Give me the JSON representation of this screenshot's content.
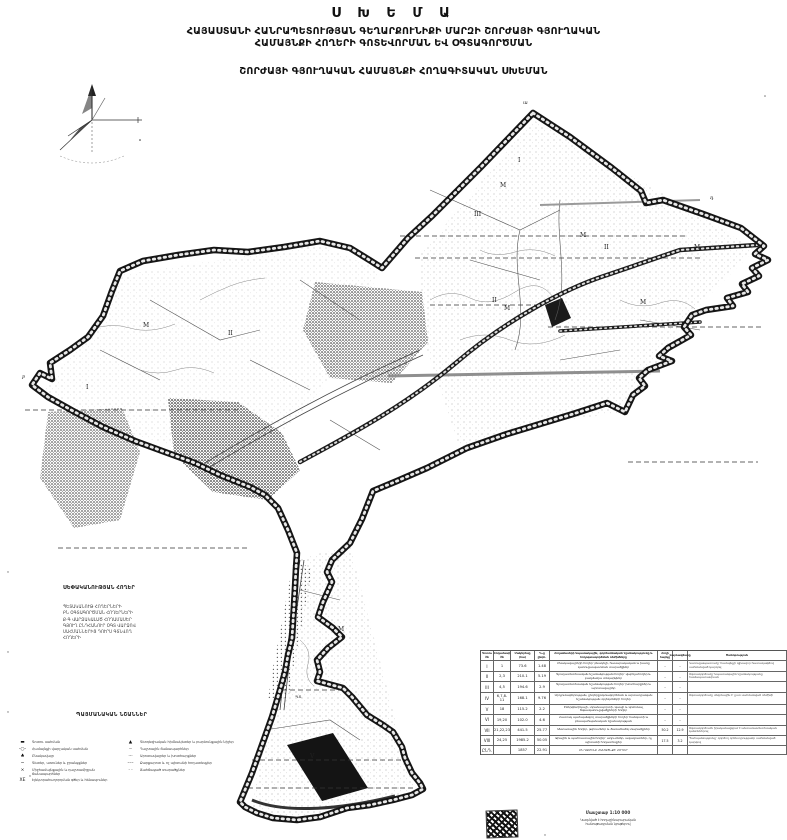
{
  "palette": {
    "ink": "#111111",
    "paper": "#ffffff",
    "boundary": "#1c1c1c",
    "halftone": "#888888"
  },
  "title": {
    "main": "Ս Խ Ե Մ Ա",
    "line1": "ՀԱՅԱՍՏԱՆԻ ՀԱՆՐԱՊԵՏՈՒԹՅԱՆ ԳԵՂԱՐՔՈՒՆԻՔԻ ՄԱՐԶԻ ՇՈՐԺԱՅԻ ԳՅՈՒՂԱԿԱՆ",
    "line2": "ՀԱՄԱՅՆՔԻ ՀՈՂԵՐԻ ԳՈՏԵՎՈՐՄԱՆ ԵՎ ՕԳՏԱԳՈՐԾՄԱՆ",
    "line3": "ՇՈՐԺԱՅԻ ԳՅՈՒՂԱԿԱՆ ՀԱՄԱՅՆՔԻ ՀՈՂԱԳԻՏԱԿԱՆ ՍԽԵՄԱՆ"
  },
  "ownership_legend": {
    "heading": "ՍԵՓԱԿԱՆՈՒԹՅԱՆ ՀՈՂԵՐ",
    "lines": [
      "ՊԵՏԱԿԱՆՈՒԹ ՀՈՂԵՐՆԵՐԻ",
      "ԲՆ ՕԳՏԱԳՈՐԾՄԱՆ ՀՈՂԵՐՆԵՐԻ",
      "Ք-Գ ՎԱՐՁԱԿԱԼԱԾ ՀՈՂԱՄԱՍԵՐ",
      "ԳՅՈՒՂ ԸՆԴՀԱՆՈՒՐ ՕԳՏ ՎԱՐՁՈՎ",
      "ՍԱՀՄԱՆՆԵՐԻՑ ԴՈՒՐՍ ԳՏՆՎՈՂ",
      "ՀՈՂԵՐԻ"
    ]
  },
  "signs_legend": {
    "heading": "ՊԱՅՄԱՆԱԿԱՆ ՆՇԱՆՆԵՐ",
    "left": [
      {
        "glyph": "▬",
        "label": "Գոտու սահման"
      },
      {
        "glyph": "-○-",
        "label": "Համայնքի վարչական սահման"
      },
      {
        "glyph": "♣",
        "label": "Բնակավայր"
      },
      {
        "glyph": "~",
        "label": "Գետեր, առուներ և ջրանցքներ"
      },
      {
        "glyph": "×",
        "label": "Միջհամայնքային և դաշտամիջյան ճանապարհներ"
      },
      {
        "glyph": "XE",
        "label": "Էլեկտրահաղորդման գծեր և հենասյուներ"
      }
    ],
    "right": [
      {
        "glyph": "▲",
        "label": "Գեոդեզիական հիմնակետեր և բարձունքային նիշեր"
      },
      {
        "glyph": "┄",
        "label": "Դաշտային ճանապարհներ"
      },
      {
        "glyph": "···",
        "label": "Արոտավայրեր և խոտհարքներ"
      },
      {
        "glyph": "–·–",
        "label": "Քարքարոտ և ոչ պիտանի հողատեսքեր"
      },
      {
        "glyph": "· ·",
        "label": "Ճահճացած տարածքներ"
      }
    ]
  },
  "table": {
    "headers": {
      "h1": "Գոտու №",
      "h2": "Հողամասի №",
      "h3": "Մակերեսը (հա)",
      "h4": "%-ը ընդհ.",
      "h5": "Հողամասերի նպատակային, գործառնական նշանակությունը և հողօգտագործման ռեժիմները",
      "h6": "Հողի հարկը",
      "h7": "Վարձավճարը",
      "h8": "Ծանոթություն"
    },
    "rows": [
      {
        "zone": "I",
        "parcels": "1",
        "area": "73.6",
        "pct": "1.48",
        "desc": "Բնակավայրերի հողեր՝ բնակելի, հասարակական և խառը կառուցապատման տարածքներ",
        "tax": "–",
        "rent": "–",
        "note": "Կառուցապատումը՝ համայնքի գլխավոր հատակագծով սահմանված կարգով"
      },
      {
        "zone": "II",
        "parcels": "2,3",
        "area": "210.1",
        "pct": "5.19",
        "desc": "Գյուղատնտեսական նշանակության հողեր՝ վարելահողեր և բազմամյա տնկարկներ",
        "tax": "–",
        "rent": "–",
        "note": "Օգտագործումը՝ նպատակային նշանակությանը համապատասխան"
      },
      {
        "zone": "III",
        "parcels": "4,5",
        "area": "194.6",
        "pct": "2.9",
        "desc": "Գյուղատնտեսական նշանակության հողեր՝ խոտհարքներ և արոտավայրեր",
        "tax": "–",
        "rent": "–",
        "note": ""
      },
      {
        "zone": "IV",
        "parcels": "6,7,8-11",
        "area": "168.1",
        "pct": "9.76",
        "desc": "Արդյունաբերության, ընդերքօգտագործման և արտադրական նշանակության օբյեկտների հողեր",
        "tax": "–",
        "rent": "–",
        "note": "Օգտագործումը սեզոնային է՝ ըստ սահմանված ռեժիմի"
      },
      {
        "zone": "V",
        "parcels": "18",
        "area": "115.2",
        "pct": "2.2",
        "desc": "Էներգետիկայի, տրանսպորտի, կապի և կոմունալ ենթակառուցվածքների հողեր",
        "tax": "–",
        "rent": "–",
        "note": ""
      },
      {
        "zone": "VI",
        "parcels": "19,20",
        "area": "102.0",
        "pct": "4.6",
        "desc": "Հատուկ պահպանվող տարածքների հողեր՝ հանգստի և բնապահպանական նշանակության",
        "tax": "–",
        "rent": "–",
        "note": ""
      },
      {
        "zone": "VII",
        "parcels": "21,22,23",
        "area": "441.5",
        "pct": "25.77",
        "desc": "Անտառային հողեր, թփուտներ և ծառածածկ տարածքներ",
        "tax": "50.2",
        "rent": "12.9",
        "note": "Օգտագործումն իրականացվում է անտառատնտեսական կանոններով"
      },
      {
        "zone": "VIII",
        "parcels": "24,25",
        "area": "1985.2",
        "pct": "50.05",
        "desc": "Ջրային և պահուստային հողեր՝ աղուտներ, ավազուտներ, ոչ պիտանի հողատեսքեր",
        "tax": "17.5",
        "rent": "3.2",
        "note": "Պահպանությունը՝ գործող օրենսդրությամբ սահմանված կարգով"
      },
      {
        "zone": "ԸՆԴ.",
        "parcels": "",
        "area": "1857",
        "pct": "22.91",
        "desc": "ԸՆԴԱՄԵՆԸ ՀԱՄԱՅՆՔԻ ՀՈՂԵՐ",
        "tax": "",
        "rent": "",
        "note": ""
      }
    ]
  },
  "footer": {
    "scale": "Մասշտաբ 1:10 000",
    "note1": "Կազմված է հողաշինարարական",
    "note2": "հանութագրման նյութերով"
  },
  "map": {
    "labels": [
      {
        "t": "ա"
      },
      {
        "t": "դ"
      },
      {
        "t": "բ"
      },
      {
        "t": "I"
      },
      {
        "t": "M"
      },
      {
        "t": "III"
      },
      {
        "t": "M"
      },
      {
        "t": "II"
      },
      {
        "t": "M"
      },
      {
        "t": "II"
      },
      {
        "t": "M"
      },
      {
        "t": "M"
      },
      {
        "t": "M"
      },
      {
        "t": "II"
      },
      {
        "t": "I"
      },
      {
        "t": "M"
      },
      {
        "t": "ՊՏ"
      },
      {
        "t": "V"
      }
    ]
  }
}
